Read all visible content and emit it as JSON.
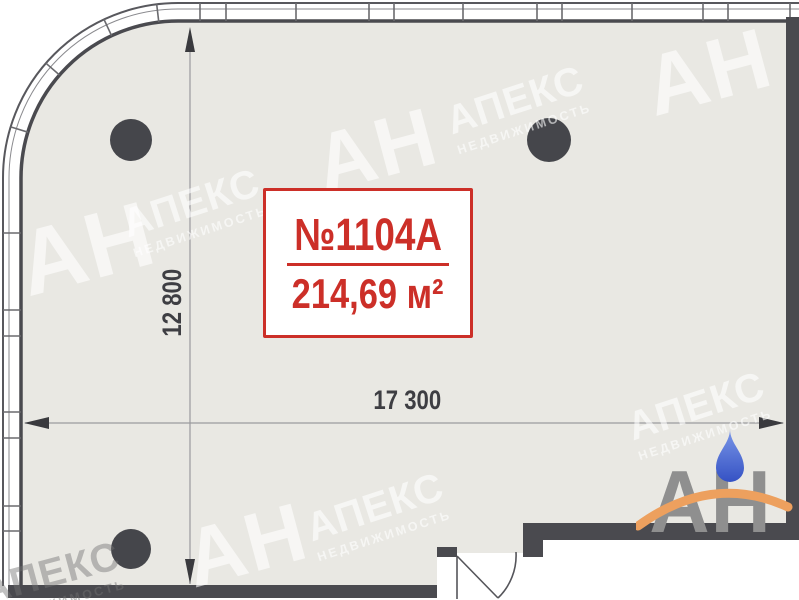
{
  "plan": {
    "unit_label": "№1104А",
    "area_label": "214,69 м²",
    "dim_vertical": "12 800",
    "dim_horizontal": "17 300",
    "columns_count": 3
  },
  "watermark": {
    "brand_short": "АН",
    "brand_name": "АПЕКС",
    "brand_sub": "НЕДВИЖИМОСТЬ"
  },
  "logo": {
    "letters": "АН"
  },
  "colors": {
    "accent_red": "#cc2f28",
    "wall_dark": "#4a4a4f",
    "floor": "#e9e8e3",
    "dim_text": "#3e3e43",
    "logo_gray": "#8f8f8f",
    "logo_orange": "#eda05e",
    "logo_blue": "#4a6ad0"
  }
}
